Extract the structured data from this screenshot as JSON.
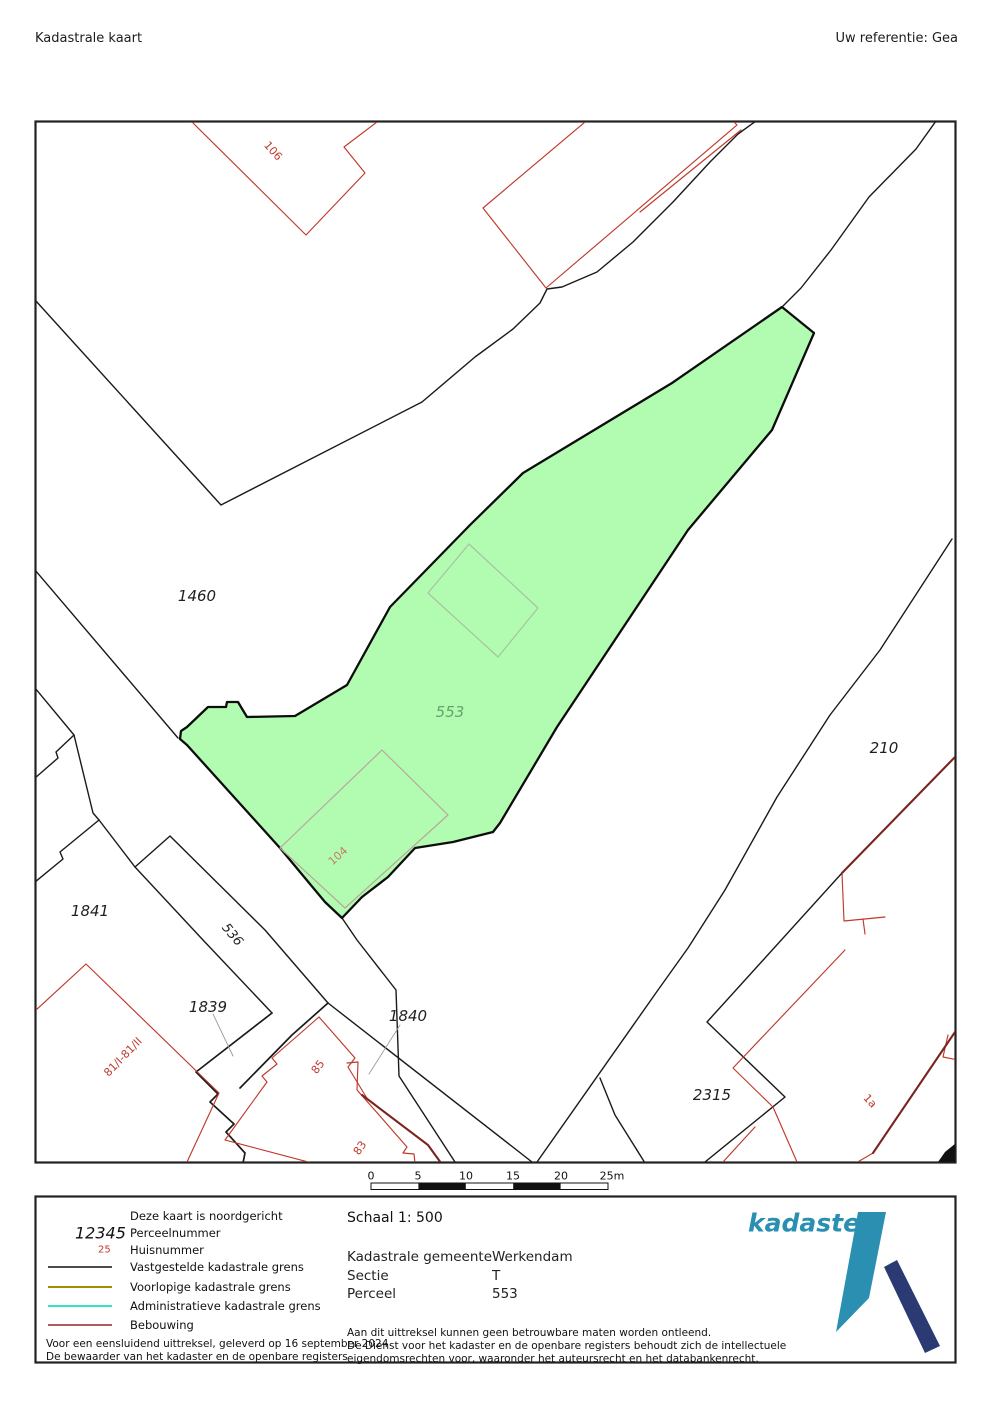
{
  "header": {
    "title": "Kadastrale kaart",
    "reference": "Uw referentie: Gea"
  },
  "map": {
    "highlight_fill": "#b2fcb2",
    "boundary_color": "#1a1a1a",
    "building_color": "#c0392b",
    "parcel_numbers": {
      "p1460": "1460",
      "p553": "553",
      "p210": "210",
      "p1841": "1841",
      "p1839": "1839",
      "p1840": "1840",
      "p2315": "2315",
      "p536": "536"
    },
    "house_numbers": {
      "h106": "106",
      "h104": "104",
      "h85": "85",
      "h83": "83",
      "h81": "81/I-81/II",
      "h1a": "1a"
    }
  },
  "scalebar": {
    "ticks": [
      "0",
      "5",
      "10",
      "15",
      "20",
      "25m"
    ]
  },
  "legend": {
    "north_note": "Deze kaart is noordgericht",
    "parcel_number_sample": "12345",
    "parcel_number_label": "Perceelnummer",
    "house_number_sample": "25",
    "house_number_label": "Huisnummer",
    "established_boundary": "Vastgestelde kadastrale grens",
    "provisional_boundary": "Voorlopige kadastrale grens",
    "administrative_boundary": "Administratieve kadastrale grens",
    "building": "Bebouwing",
    "provisional_color": "#a18f00",
    "administrative_color": "#35e3c6",
    "building_legend_color": "#992525"
  },
  "details": {
    "scale": "Schaal 1: 500",
    "fields": [
      {
        "label": "Kadastrale gemeente",
        "value": "Werkendam"
      },
      {
        "label": "Sectie",
        "value": "T"
      },
      {
        "label": "Perceel",
        "value": "553"
      }
    ],
    "note1": "Aan dit uittreksel kunnen geen betrouwbare maten worden ontleend.",
    "note2": "De Dienst voor het kadaster en de openbare registers behoudt zich de intellectuele",
    "note3": "eigendomsrechten voor, waaronder het auteursrecht en het databankenrecht.",
    "issue_line1": "Voor een eensluidend uittreksel, geleverd op 16 september 2024",
    "issue_line2": "De bewaarder van het kadaster en de openbare registers"
  },
  "logo": {
    "wordmark": "kadaster",
    "teal": "#2a8fb1",
    "navy": "#2c3a74"
  }
}
